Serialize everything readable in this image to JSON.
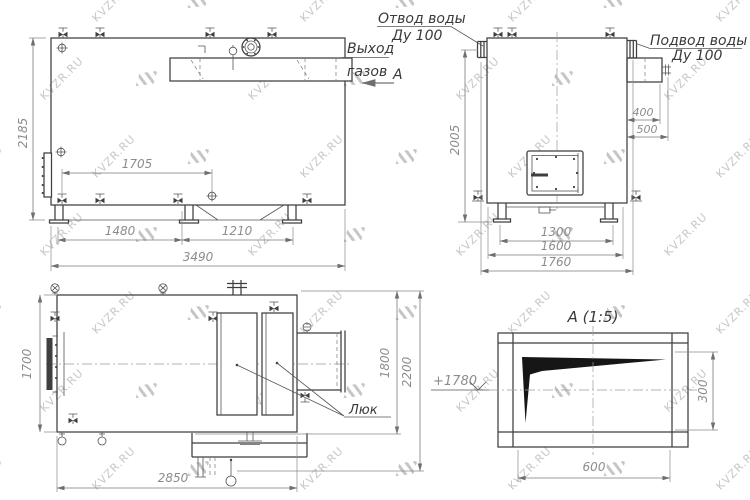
{
  "watermark": {
    "text": "KVZR.RU"
  },
  "labels": {
    "water_outlet": {
      "line1": "Отвод воды",
      "line2": "Ду 100"
    },
    "water_supply": {
      "line1": "Подвод воды",
      "line2": "Ду 100"
    },
    "gas_outlet": {
      "line1": "Выход",
      "line2": "газов"
    },
    "section_mark": "А",
    "hatch": "Люк",
    "detail_title": "А (1:5)",
    "elevation": "+1780"
  },
  "dimensions": {
    "front_height": "2185",
    "front_top": "1705",
    "front_base_left": "1480",
    "front_base_right": "1210",
    "front_overall": "3490",
    "side_inlet_offset": "400",
    "side_inlet_total": "500",
    "side_base": "1300",
    "side_width": "1600",
    "side_overall": "1760",
    "side_height_axis": "2005",
    "plan_width": "1700",
    "plan_depth_inner": "1800",
    "plan_depth_outer": "2200",
    "plan_length": "2850",
    "detail_opening_width": "600",
    "detail_opening_height": "300"
  }
}
